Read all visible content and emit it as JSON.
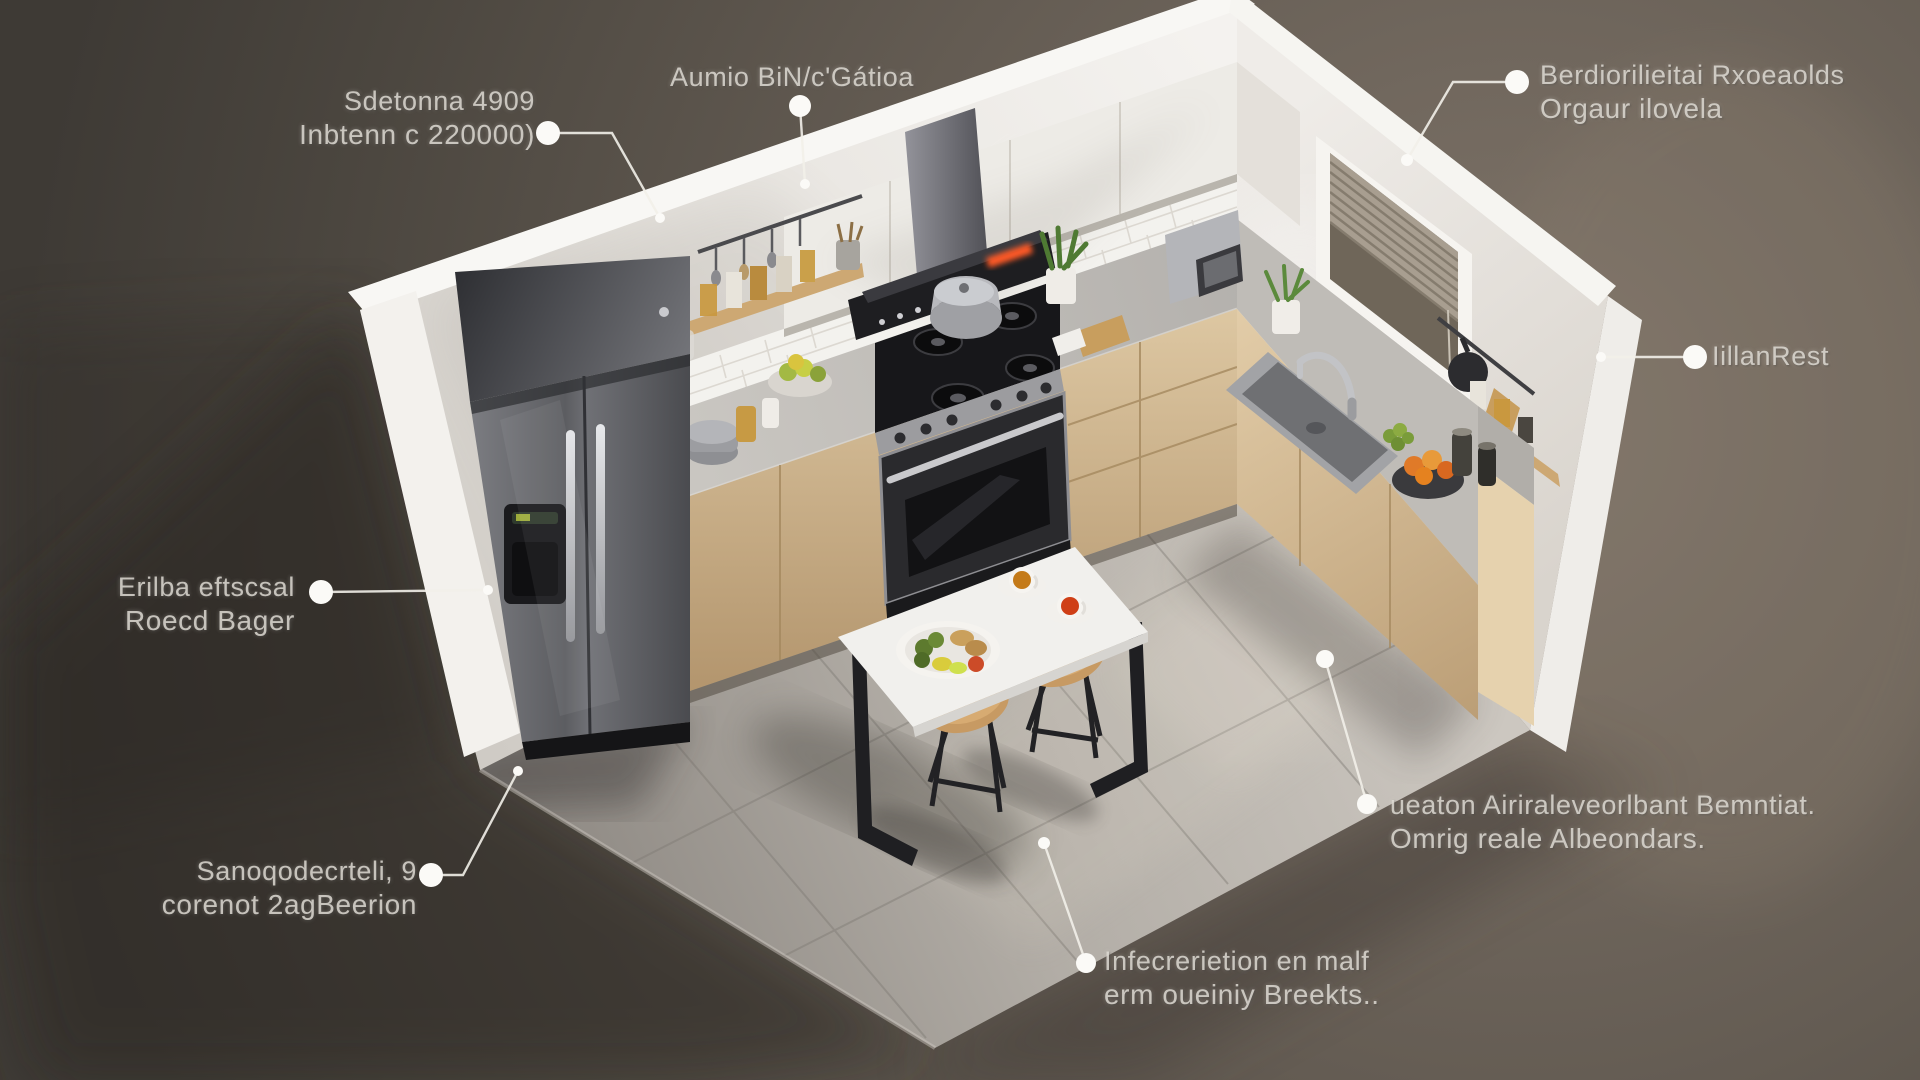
{
  "annotations": [
    {
      "id": "dimensions",
      "line1": "Sdetonna 4909",
      "line2": "Inbtenn c 220000)"
    },
    {
      "id": "ventilation",
      "line1": "Aumio BiN/c'Gátioa",
      "line2": ""
    },
    {
      "id": "overhead-storage",
      "line1": "Berdiorilieitai Rxoeaolds",
      "line2": "Orgaur ilovela"
    },
    {
      "id": "wall-finish",
      "line1": "IillanRest",
      "line2": ""
    },
    {
      "id": "refrigerator",
      "line1": "Erilba eftscsal",
      "line2": "Roecd Bager"
    },
    {
      "id": "flooring",
      "line1": "Sanoqodecrteli, 9",
      "line2": "corenot 2agBeerion"
    },
    {
      "id": "base-cabinets",
      "line1": "ueaton Airiraleveorlbant Bemntiat.",
      "line2": "Omrig reale Albeondars."
    },
    {
      "id": "dining-set",
      "line1": "Infecrerietion en malf",
      "line2": "erm oueiniy Breekts.."
    }
  ],
  "palette": {
    "background": "#6b6158",
    "wall": "#efedea",
    "counter_marble": "#c5c2bd",
    "cabinet_wood": "#d2b88f",
    "floor_tile": "#b8b3ac",
    "stainless": "#7c7d81",
    "hood_black": "#1d1d20",
    "accent_display": "#ff5a26",
    "label_text": "#ddd8d1",
    "leader": "#f2efe9"
  }
}
